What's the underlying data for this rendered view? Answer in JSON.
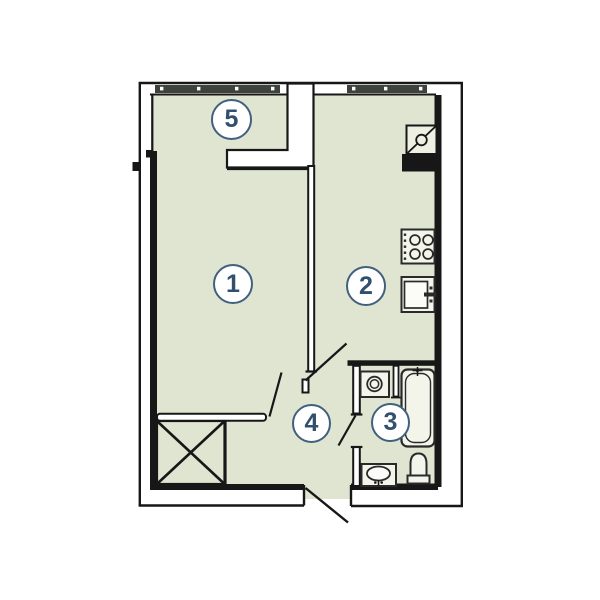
{
  "plan": {
    "type": "apartment-floor-plan",
    "rooms": [
      {
        "id": "living-room",
        "number": "1"
      },
      {
        "id": "kitchen",
        "number": "2"
      },
      {
        "id": "bathroom",
        "number": "3"
      },
      {
        "id": "hallway",
        "number": "4"
      },
      {
        "id": "balcony",
        "number": "5"
      }
    ],
    "fixtures": [
      "balcony-window",
      "kitchen-window",
      "ventilation-shaft",
      "four-burner-stove",
      "kitchen-sink",
      "washing-machine",
      "bathtub",
      "toilet",
      "washbasin",
      "built-in-wardrobe",
      "entrance-door-swing",
      "kitchen-door-swing",
      "living-room-door-swing",
      "bathroom-door-swing"
    ],
    "colors": {
      "floor": "#dfe5d1",
      "wall": "#171717",
      "window_glass": "#3d423c",
      "fixture_fill": "#f3f5ea",
      "label_accent": "#41607e",
      "label_text": "#32506e",
      "label_fill": "#ffffff"
    }
  }
}
